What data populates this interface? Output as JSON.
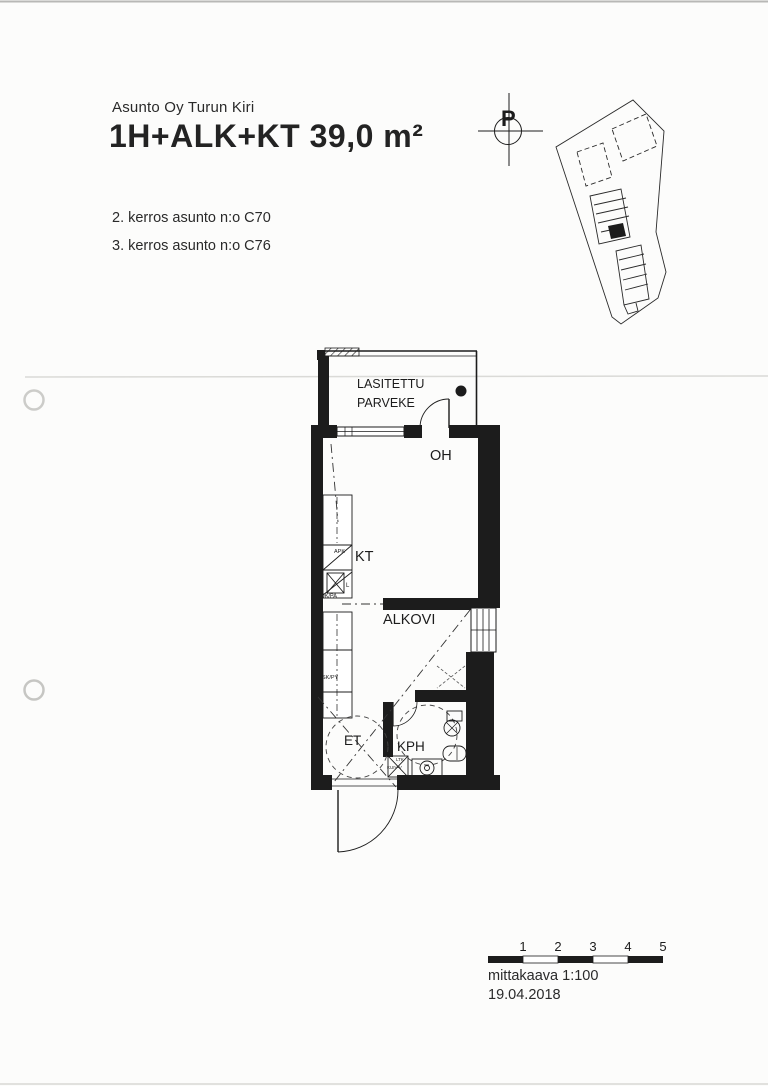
{
  "document": {
    "company": "Asunto Oy Turun Kiri",
    "apartment_type": "1H+ALK+KT 39,0 m²",
    "floor_lines": [
      "2. kerros asunto n:o C70",
      "3. kerros asunto n:o C76"
    ],
    "scale_text": "mittakaava 1:100",
    "date": "19.04.2018",
    "north_label": "P",
    "scale_ticks": [
      "1",
      "2",
      "3",
      "4",
      "5"
    ]
  },
  "floor_plan": {
    "balcony_line1": "LASITETTU",
    "balcony_line2": "PARVEKE",
    "living_room": "OH",
    "kitchen": "KT",
    "alcove": "ALKOVI",
    "hall": "ET",
    "bathroom": "KPH",
    "appliances": {
      "dishwasher": "APK",
      "stove": "L",
      "fridge_freezer": "JK/PA",
      "cleaning_closet": "SK/PY",
      "laundry_1": "LTK",
      "laundry_2": "KUIV-V"
    }
  },
  "colors": {
    "ink": "#1c1c1c",
    "paper": "#fcfcfb"
  }
}
